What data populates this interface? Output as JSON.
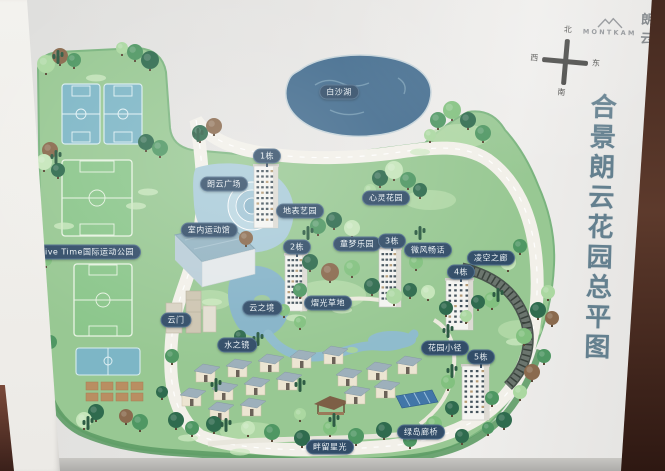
{
  "sign": {
    "brand": {
      "logo_en": "MONTKAM",
      "logo_cn": "朗云"
    },
    "title": "合景朗云花园总平图",
    "compass": {
      "north": "北",
      "south": "南",
      "east": "东",
      "west": "西"
    }
  },
  "map": {
    "labels": [
      {
        "id": "baishahu-lake",
        "text": "白沙湖"
      },
      {
        "id": "building-1",
        "text": "1栋"
      },
      {
        "id": "langyun-plaza",
        "text": "朗云广场"
      },
      {
        "id": "dibiao-art-garden",
        "text": "地表艺园"
      },
      {
        "id": "indoor-sports-hall",
        "text": "室内运动馆"
      },
      {
        "id": "live-time-sports-park",
        "text": "Live Time国际运动公园"
      },
      {
        "id": "xinling-garden",
        "text": "心灵花园"
      },
      {
        "id": "building-2",
        "text": "2栋"
      },
      {
        "id": "tongmeng-playground",
        "text": "童梦乐园"
      },
      {
        "id": "building-3",
        "text": "3栋"
      },
      {
        "id": "weifeng-changhua",
        "text": "微风畅话"
      },
      {
        "id": "lingkong-corridor",
        "text": "凌空之廊"
      },
      {
        "id": "building-4",
        "text": "4栋"
      },
      {
        "id": "yiguang-lawn",
        "text": "熠光草地"
      },
      {
        "id": "yunmen-gate",
        "text": "云门"
      },
      {
        "id": "yunzhijing",
        "text": "云之境"
      },
      {
        "id": "shuizhijing",
        "text": "水之镜"
      },
      {
        "id": "garden-path",
        "text": "花园小径"
      },
      {
        "id": "building-5",
        "text": "5栋"
      },
      {
        "id": "lvdao-gallery-bridge",
        "text": "绿岛廊桥"
      },
      {
        "id": "panliu-starlight",
        "text": "畔留星光"
      }
    ],
    "colors": {
      "label_pill": "#324d68",
      "land_green": "#98c893",
      "lake_blue": "#436c8e",
      "title_text": "#64808f"
    }
  }
}
